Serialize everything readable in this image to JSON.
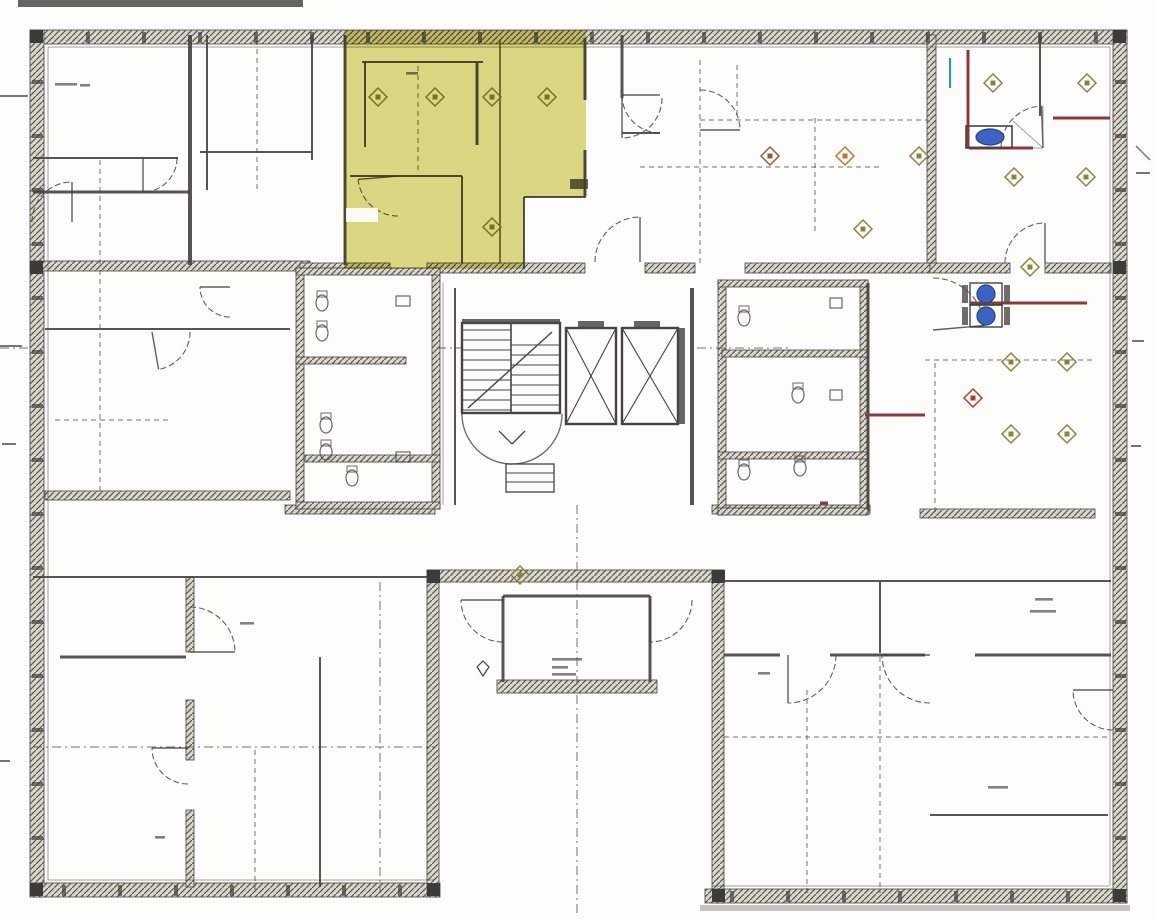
{
  "title": "Scanned architectural floor plan, one room highlighted yellow",
  "palette": {
    "paper": "#fcfcfa",
    "ink": "#45443f",
    "inkLight": "#8b8a82",
    "hatchLine": "#57564f",
    "hatchFill": "#d9d6cc",
    "yellow": "#c9c23a",
    "red": "#8c3a40",
    "blue": "#3a63c4",
    "teal": "#2fa08e",
    "olive": "#8b8340",
    "orange": "#c2762e",
    "brown": "#91603a",
    "redDiamond": "#b23c2e"
  },
  "highlight": {
    "polygon": [
      [
        344,
        30
      ],
      [
        586,
        30
      ],
      [
        586,
        197
      ],
      [
        524,
        197
      ],
      [
        524,
        269
      ],
      [
        344,
        269
      ]
    ],
    "opacity": 0.62,
    "eraser": [
      346,
      208,
      32,
      14
    ]
  },
  "walls_hatched": [
    [
      30,
      30,
      1097,
      14
    ],
    [
      30,
      30,
      14,
      867
    ],
    [
      30,
      883,
      410,
      14
    ],
    [
      427,
      570,
      12,
      327
    ],
    [
      427,
      570,
      297,
      12
    ],
    [
      712,
      570,
      12,
      333
    ],
    [
      705,
      889,
      422,
      14
    ],
    [
      1113,
      30,
      14,
      873
    ],
    [
      497,
      680,
      160,
      13
    ],
    [
      30,
      261,
      280,
      10
    ],
    [
      300,
      263,
      90,
      10
    ],
    [
      427,
      263,
      158,
      10
    ],
    [
      645,
      263,
      50,
      10
    ],
    [
      745,
      263,
      185,
      10
    ],
    [
      930,
      263,
      80,
      10
    ],
    [
      1045,
      263,
      66,
      10
    ],
    [
      45,
      491,
      245,
      9
    ],
    [
      285,
      505,
      150,
      9
    ],
    [
      712,
      505,
      158,
      9
    ],
    [
      920,
      509,
      175,
      9
    ],
    [
      296,
      268,
      8,
      241
    ],
    [
      432,
      268,
      8,
      241
    ],
    [
      296,
      268,
      144,
      7
    ],
    [
      296,
      357,
      110,
      7
    ],
    [
      305,
      455,
      135,
      7
    ],
    [
      296,
      502,
      144,
      7
    ],
    [
      718,
      280,
      8,
      235
    ],
    [
      860,
      280,
      8,
      235
    ],
    [
      718,
      280,
      150,
      7
    ],
    [
      722,
      350,
      146,
      7
    ],
    [
      718,
      452,
      150,
      7
    ],
    [
      718,
      508,
      150,
      7
    ],
    [
      927,
      35,
      9,
      228
    ],
    [
      186,
      577,
      8,
      75
    ],
    [
      186,
      700,
      8,
      60
    ],
    [
      186,
      810,
      8,
      77
    ]
  ],
  "corner_blocks": [
    [
      30,
      30
    ],
    [
      1113,
      30
    ],
    [
      30,
      883
    ],
    [
      427,
      883
    ],
    [
      712,
      889
    ],
    [
      1113,
      889
    ],
    [
      427,
      570
    ],
    [
      712,
      570
    ],
    [
      30,
      261
    ],
    [
      1113,
      261
    ]
  ],
  "segments": [
    [
      33,
      158,
      178,
      158,
      2
    ],
    [
      33,
      192,
      190,
      192,
      3
    ],
    [
      200,
      152,
      312,
      152,
      2
    ],
    [
      190,
      35,
      190,
      265,
      4
    ],
    [
      207,
      35,
      207,
      190,
      2
    ],
    [
      312,
      35,
      312,
      160,
      2
    ],
    [
      345,
      35,
      345,
      265,
      3
    ],
    [
      362,
      62,
      483,
      62,
      2
    ],
    [
      365,
      62,
      365,
      147,
      2
    ],
    [
      477,
      62,
      477,
      145,
      3
    ],
    [
      350,
      176,
      462,
      176,
      2
    ],
    [
      462,
      176,
      462,
      263,
      2
    ],
    [
      500,
      40,
      500,
      263,
      1.5
    ],
    [
      585,
      38,
      585,
      100,
      3
    ],
    [
      585,
      150,
      585,
      196,
      3
    ],
    [
      524,
      197,
      524,
      269,
      2
    ],
    [
      524,
      197,
      586,
      197,
      2
    ],
    [
      622,
      35,
      622,
      98,
      3
    ],
    [
      622,
      133,
      660,
      133,
      2
    ],
    [
      45,
      329,
      290,
      329,
      2
    ],
    [
      60,
      657,
      186,
      657,
      3
    ],
    [
      320,
      657,
      320,
      887,
      2
    ],
    [
      724,
      655,
      780,
      655,
      3
    ],
    [
      830,
      655,
      925,
      655,
      3
    ],
    [
      975,
      655,
      1111,
      655,
      3
    ],
    [
      880,
      582,
      880,
      653,
      2
    ],
    [
      455,
      288,
      455,
      505,
      2
    ],
    [
      692,
      288,
      692,
      505,
      4
    ],
    [
      1040,
      35,
      1040,
      116,
      2
    ],
    [
      868,
      283,
      868,
      510,
      3
    ],
    [
      503,
      596,
      650,
      596,
      3
    ],
    [
      503,
      596,
      503,
      682,
      3
    ],
    [
      650,
      596,
      650,
      682,
      3
    ],
    [
      930,
      815,
      1108,
      815,
      2
    ],
    [
      443,
      283,
      443,
      505,
      1
    ],
    [
      33,
      577,
      427,
      577,
      2
    ],
    [
      724,
      581,
      1111,
      581,
      2
    ],
    [
      48,
      47,
      1110,
      47,
      1
    ],
    [
      48,
      47,
      48,
      880,
      1
    ],
    [
      1110,
      47,
      1110,
      885,
      1
    ],
    [
      48,
      880,
      435,
      880,
      1
    ],
    [
      712,
      886,
      1110,
      886,
      1
    ],
    [
      1043,
      148,
      1001,
      148,
      1
    ],
    [
      1043,
      148,
      1013,
      121,
      1
    ],
    [
      1043,
      148,
      1043,
      106,
      1
    ]
  ],
  "dashes": [
    [
      100,
      160,
      100,
      265,
      "d"
    ],
    [
      257,
      40,
      257,
      190,
      "d"
    ],
    [
      418,
      66,
      418,
      172,
      "d"
    ],
    [
      700,
      60,
      700,
      263,
      "d"
    ],
    [
      815,
      118,
      815,
      235,
      "d"
    ],
    [
      737,
      65,
      737,
      120,
      "d"
    ],
    [
      700,
      120,
      928,
      120,
      "d"
    ],
    [
      55,
      420,
      172,
      420,
      "d"
    ],
    [
      100,
      270,
      100,
      492,
      "d"
    ],
    [
      925,
      360,
      1093,
      360,
      "d"
    ],
    [
      935,
      363,
      935,
      512,
      "d"
    ],
    [
      577,
      505,
      577,
      913,
      "dd"
    ],
    [
      380,
      582,
      380,
      893,
      "dd"
    ],
    [
      33,
      747,
      435,
      747,
      "dd"
    ],
    [
      724,
      737,
      1111,
      737,
      "d"
    ],
    [
      880,
      657,
      880,
      893,
      "d"
    ],
    [
      807,
      690,
      807,
      893,
      "d"
    ],
    [
      255,
      750,
      255,
      893,
      "d"
    ],
    [
      0,
      348,
      28,
      348,
      "dd"
    ],
    [
      437,
      348,
      462,
      348,
      "dd"
    ],
    [
      697,
      348,
      790,
      348,
      "dd"
    ],
    [
      640,
      167,
      880,
      167,
      "d"
    ]
  ],
  "door_arcs": [
    [
      143,
      158,
      34,
      0,
      90
    ],
    [
      230,
      287,
      30,
      90,
      180
    ],
    [
      152,
      332,
      38,
      0,
      80
    ],
    [
      398,
      176,
      40,
      90,
      175
    ],
    [
      640,
      262,
      45,
      180,
      270
    ],
    [
      660,
      95,
      38,
      90,
      180
    ],
    [
      700,
      130,
      40,
      270,
      360
    ],
    [
      622,
      98,
      40,
      0,
      90
    ],
    [
      1043,
      148,
      42,
      180,
      268
    ],
    [
      933,
      330,
      52,
      270,
      355
    ],
    [
      1045,
      263,
      40,
      180,
      270
    ],
    [
      190,
      652,
      45,
      270,
      360
    ],
    [
      188,
      748,
      36,
      90,
      180
    ],
    [
      788,
      655,
      48,
      0,
      90
    ],
    [
      930,
      655,
      48,
      90,
      180
    ],
    [
      503,
      600,
      42,
      90,
      180
    ],
    [
      650,
      600,
      42,
      0,
      90
    ],
    [
      1113,
      690,
      40,
      90,
      180
    ],
    [
      72,
      222,
      40,
      180,
      270
    ]
  ],
  "diamonds": {
    "olive": [
      [
        378,
        97
      ],
      [
        435,
        97
      ],
      [
        492,
        97
      ],
      [
        547,
        97
      ],
      [
        492,
        227
      ],
      [
        919,
        156
      ],
      [
        863,
        229
      ],
      [
        993,
        83
      ],
      [
        1087,
        83
      ],
      [
        1014,
        177
      ],
      [
        1086,
        177
      ],
      [
        1030,
        267
      ],
      [
        1011,
        362
      ],
      [
        1067,
        362
      ],
      [
        1011,
        434
      ],
      [
        1067,
        434
      ],
      [
        520,
        575
      ]
    ],
    "orange": [
      [
        845,
        156
      ]
    ],
    "brown": [
      [
        770,
        156
      ]
    ],
    "redDiamond": [
      [
        973,
        398
      ]
    ]
  },
  "red_lines": [
    [
      968,
      50,
      968,
      148
    ],
    [
      1053,
      118,
      1110,
      118
    ],
    [
      969,
      148,
      1033,
      148
    ],
    [
      970,
      303,
      1087,
      303
    ],
    [
      865,
      415,
      925,
      415
    ],
    [
      820,
      503,
      828,
      503
    ]
  ],
  "teal_marks": [
    [
      950,
      58,
      950,
      88
    ]
  ],
  "blue_units": {
    "oval": {
      "box": [
        966,
        126,
        46,
        22
      ],
      "cx": 990,
      "cy": 137,
      "rx": 14,
      "ry": 8
    },
    "circle_boxes": [
      [
        970,
        283,
        32,
        22
      ],
      [
        970,
        305,
        32,
        22
      ]
    ],
    "circles": [
      [
        986,
        294,
        9
      ],
      [
        986,
        316,
        9
      ]
    ],
    "side_ticks": [
      [
        962,
        285,
        6,
        18
      ],
      [
        1004,
        285,
        6,
        18
      ],
      [
        962,
        307,
        6,
        18
      ],
      [
        1004,
        307,
        6,
        18
      ]
    ]
  },
  "stair": {
    "x": 462,
    "y": 323,
    "w": 98,
    "h": 90,
    "divider": 511,
    "tread_step": 10,
    "diag": [
      468,
      408,
      552,
      332
    ],
    "arc_below": [
      512,
      414,
      50
    ],
    "check_mark": [
      [
        499,
        431,
        512,
        444
      ],
      [
        512,
        444,
        525,
        431
      ]
    ],
    "legend": [
      506,
      464,
      48,
      28
    ]
  },
  "elevators": [
    [
      566,
      328,
      50,
      96
    ],
    [
      622,
      328,
      56,
      96
    ]
  ],
  "extra_rects": [
    [
      570,
      179,
      18,
      10
    ],
    [
      578,
      321,
      26,
      8
    ],
    [
      634,
      321,
      26,
      8
    ],
    [
      678,
      328,
      7,
      96
    ],
    [
      462,
      319,
      98,
      5
    ]
  ],
  "fixture_ellipses": [
    [
      322,
      303
    ],
    [
      322,
      333
    ],
    [
      326,
      425
    ],
    [
      326,
      452
    ],
    [
      352,
      478
    ],
    [
      744,
      318
    ],
    [
      744,
      472
    ],
    [
      798,
      395
    ],
    [
      800,
      468
    ]
  ],
  "fixture_rects": [
    [
      396,
      296,
      14,
      10
    ],
    [
      396,
      452,
      14,
      10
    ],
    [
      830,
      298,
      12,
      10
    ],
    [
      830,
      390,
      12,
      10
    ]
  ],
  "marks": [
    [
      483,
      668
    ]
  ],
  "labels_illegible": [
    [
      55,
      83,
      22
    ],
    [
      80,
      84,
      10
    ],
    [
      406,
      72,
      12
    ],
    [
      552,
      658,
      30
    ],
    [
      552,
      666,
      16
    ],
    [
      552,
      673,
      24
    ],
    [
      1035,
      598,
      18
    ],
    [
      1030,
      610,
      26
    ],
    [
      988,
      786,
      20
    ],
    [
      240,
      622,
      14
    ],
    [
      155,
      836,
      10
    ],
    [
      758,
      672,
      12
    ]
  ],
  "artifacts": {
    "top_bar": [
      18,
      0,
      285,
      7
    ],
    "ticks": [
      [
        0,
        95,
        28
      ],
      [
        0,
        345,
        22
      ],
      [
        2,
        443,
        14
      ],
      [
        0,
        760,
        10
      ],
      [
        1136,
        172,
        14
      ],
      [
        1132,
        340,
        12
      ],
      [
        1131,
        445,
        10
      ]
    ],
    "bottom_smudge": [
      700,
      905,
      430,
      6
    ],
    "corner_diag": [
      1136,
      146,
      1150,
      160
    ]
  },
  "wall_ticks": {
    "top": {
      "axis": "h",
      "y": 32,
      "x0": 86,
      "x1": 1100,
      "step": 56
    },
    "left": {
      "axis": "v",
      "x": 32,
      "y0": 80,
      "y1": 860,
      "step": 54
    },
    "bottomL": {
      "axis": "h",
      "y": 885,
      "x0": 62,
      "x1": 420,
      "step": 56
    },
    "bottomR": {
      "axis": "h",
      "y": 891,
      "x0": 730,
      "x1": 1100,
      "step": 56
    },
    "right": {
      "axis": "v",
      "x": 1115,
      "y0": 80,
      "y1": 880,
      "step": 54
    }
  }
}
